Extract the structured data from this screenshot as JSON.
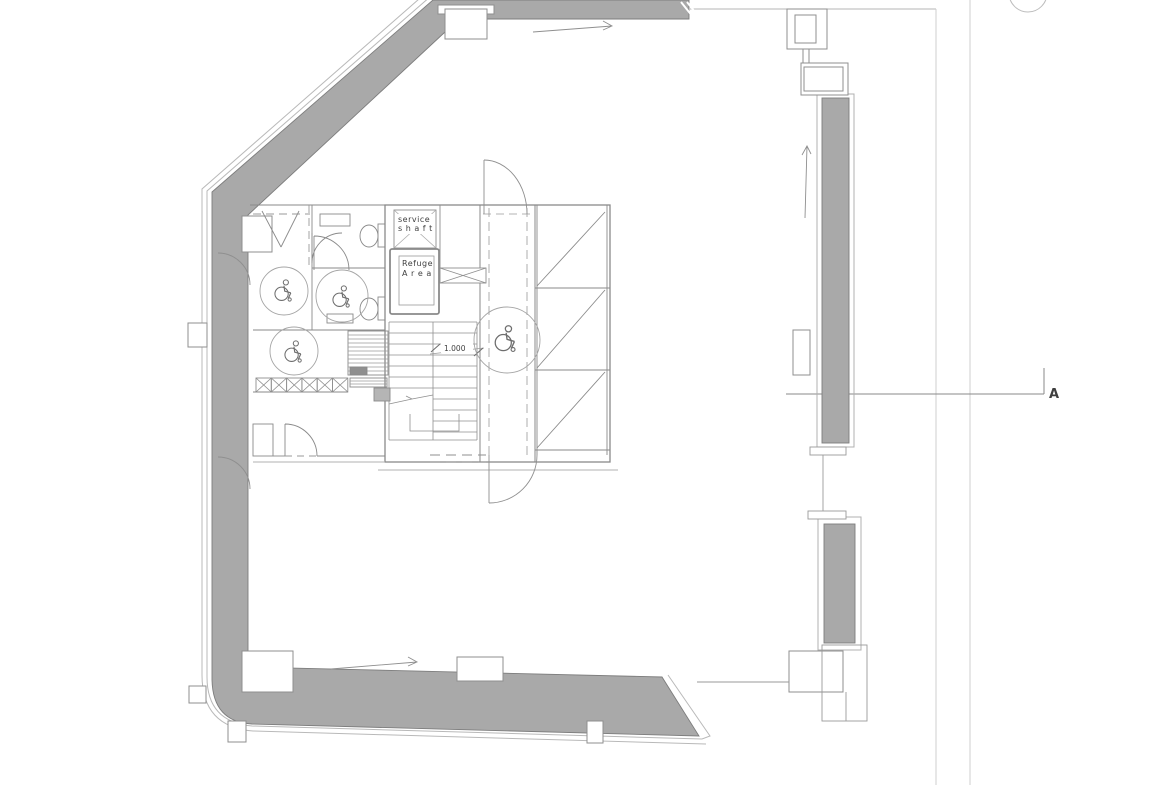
{
  "page": {
    "background": "#ffffff",
    "kind": "architectural floor plan drawing"
  },
  "colors": {
    "wall_fill": "#a9a9a9",
    "wall_outline": "#7d7d7d",
    "line": "#8f8f8f",
    "thin_line": "#b0b0b0",
    "faint_grid_line": "#cfcfcf",
    "text": "#3f3f3f"
  },
  "labels": {
    "service_shaft": {
      "line1": "service",
      "line2": "s h a f t"
    },
    "refuge_area": {
      "line1": "Refuge",
      "line2": "A r e a"
    },
    "stair_level": "1.000",
    "section_marker": "A"
  },
  "icons": {
    "wheelchair": "wheelchair-icon",
    "direction_arrow": "direction-arrow-icon",
    "toilet": "toilet-icon",
    "door_swing": "door-swing-arc",
    "stair": "stair-flight",
    "section_cut": "section-cut-line"
  },
  "symbols": {
    "wheelchair_symbols": 4,
    "accessible_wc_turning_circles": 3,
    "direction_arrows": 3,
    "window_strips": 2,
    "grid_bubbles_partial": 1
  }
}
